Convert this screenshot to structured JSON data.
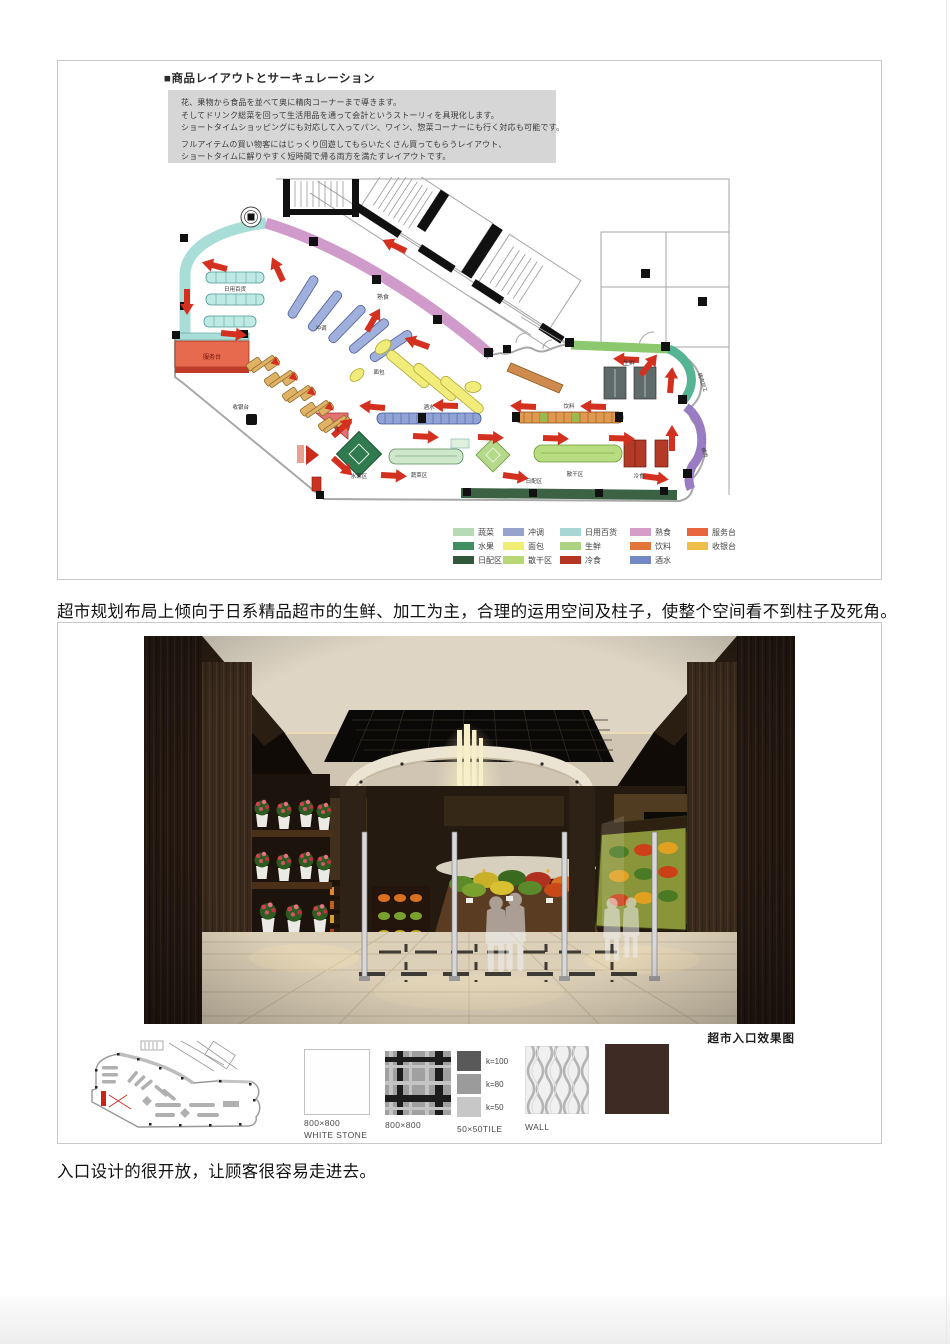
{
  "panel1": {
    "title": "■商品レイアウトとサーキュレーション",
    "description": [
      "花、果物から食品を並べて奥に精肉コーナーまで導きます。",
      "そしてドリンク総菜を回って生活用品を通って会計というストーリィを具現化します。",
      "ショートタイムショッピングにも対応して入ってパン、ワイン、惣菜コーナーにも行く対応も可能です。",
      "フルアイテムの買い物客にはじっくり回遊してもらいたくさん買ってもらうレイアウト、",
      "ショートタイムに解りやすく短時間で帰る両方を満たすレイアウトです。"
    ],
    "plan": {
      "riyong": "日用百货",
      "shushi": "熟食",
      "chongtiao": "冲调",
      "mianbao": "面包",
      "jiushui": "酒水",
      "yinliao": "饮料",
      "shengxian": "生鲜",
      "jingroujiagong": "精肉加工",
      "jingrou": "精肉",
      "fuwutai": "服务台",
      "shouyintai": "收银台",
      "hua": "花",
      "shuiguoqu": "水果区",
      "shucaiqu": "蔬菜区",
      "sanganqu": "散干区",
      "lengshi": "冷食",
      "ripeiqu": "日配区"
    },
    "legend": {
      "rows": [
        [
          {
            "label": "蔬菜",
            "color": "#b7d9b3"
          },
          {
            "label": "冲调",
            "color": "#97a3cd"
          },
          {
            "label": "日用百货",
            "color": "#a7d6d4"
          },
          {
            "label": "熟食",
            "color": "#d59dc9"
          },
          {
            "label": "服务台",
            "color": "#e8653e"
          }
        ],
        [
          {
            "label": "水果",
            "color": "#3f8f63"
          },
          {
            "label": "面包",
            "color": "#f1ee74"
          },
          {
            "label": "生鲜",
            "color": "#abd381"
          },
          {
            "label": "饮料",
            "color": "#e2763a"
          },
          {
            "label": "收银台",
            "color": "#edbf4a"
          }
        ],
        [
          {
            "label": "日配区",
            "color": "#31583b"
          },
          {
            "label": "散干区",
            "color": "#b7d877"
          },
          {
            "label": "冷食",
            "color": "#b43524"
          },
          {
            "label": "酒水",
            "color": "#7389c5"
          }
        ]
      ]
    }
  },
  "paragraph1": "超市规划布局上倾向于日系精品超市的生鲜、加工为主，合理的运用空间及柱子，使整个空间看不到柱子及死角。",
  "panel2": {
    "caption": "超市入口效果图",
    "photo": {
      "drinks_sign": "DRINKS",
      "fruit_sign": "FRU"
    },
    "materials": {
      "white_stone": {
        "size": "800×800",
        "name": "WHITE STONE"
      },
      "plaid_tile": {
        "size": "800×800"
      },
      "tile_k": {
        "items": [
          {
            "label": "k=100",
            "color": "#595959"
          },
          {
            "label": "k=80",
            "color": "#9b9b9b"
          },
          {
            "label": "k=50",
            "color": "#c7c7c7"
          }
        ],
        "caption": "50×50TILE"
      },
      "wall": {
        "label": "WALL"
      },
      "brown_color": "#3e2b23"
    }
  },
  "paragraph2": "入口设计的很开放，让顾客很容易走进去。"
}
